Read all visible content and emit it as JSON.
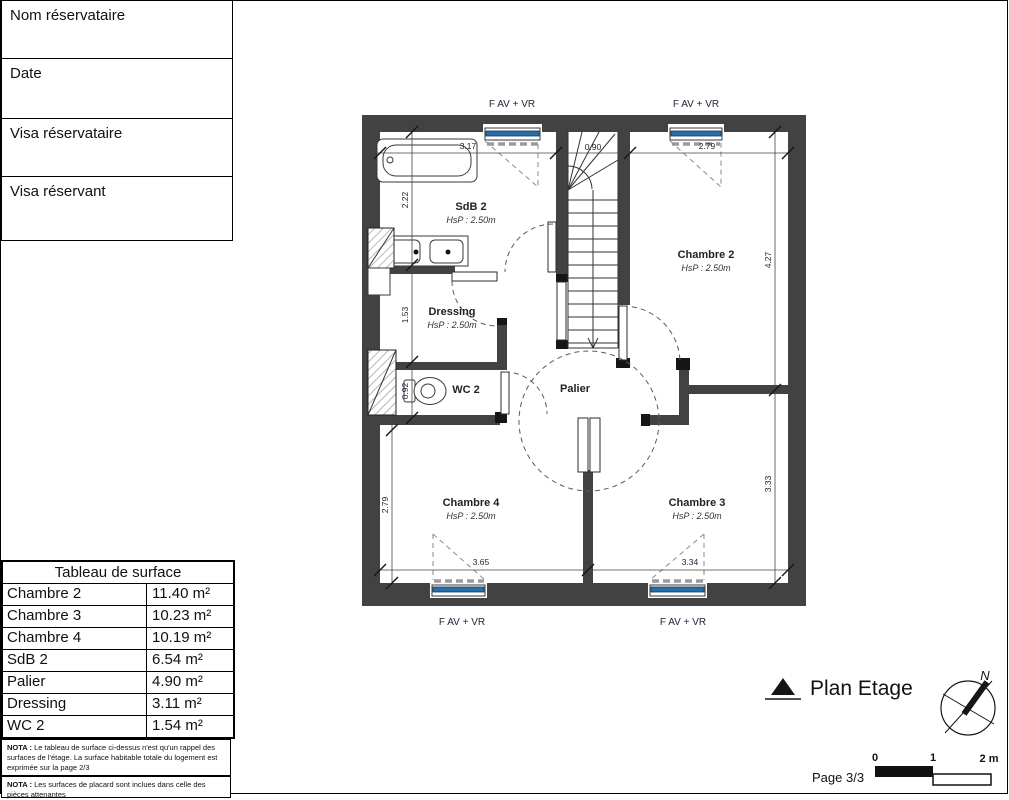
{
  "form": {
    "rows": [
      {
        "label": "Nom réservataire"
      },
      {
        "label": "Date"
      },
      {
        "label": "Visa réservataire"
      },
      {
        "label": "Visa réservant"
      }
    ]
  },
  "surface_table": {
    "title": "Tableau de surface",
    "rows": [
      {
        "name": "Chambre 2",
        "area": "11.40 m²"
      },
      {
        "name": "Chambre 3",
        "area": "10.23 m²"
      },
      {
        "name": "Chambre 4",
        "area": "10.19 m²"
      },
      {
        "name": "SdB 2",
        "area": "6.54 m²"
      },
      {
        "name": "Palier",
        "area": "4.90 m²"
      },
      {
        "name": "Dressing",
        "area": "3.11 m²"
      },
      {
        "name": "WC 2",
        "area": "1.54 m²"
      }
    ],
    "notes": [
      {
        "prefix": "NOTA :",
        "text": "Le tableau de surface ci-dessus n'est qu'un rappel des surfaces de l'étage. La surface habitable totale du logement est exprimée sur la page 2/3"
      },
      {
        "prefix": "NOTA :",
        "text": "Les surfaces de placard sont inclues dans celle des pièces attenantes"
      }
    ]
  },
  "plan": {
    "window_label": "F AV + VR",
    "rooms": [
      {
        "name": "SdB 2",
        "hsp": "HsP : 2.50m"
      },
      {
        "name": "Dressing",
        "hsp": "HsP : 2.50m"
      },
      {
        "name": "WC 2",
        "hsp": ""
      },
      {
        "name": "Palier",
        "hsp": ""
      },
      {
        "name": "Chambre 2",
        "hsp": "HsP : 2.50m"
      },
      {
        "name": "Chambre 3",
        "hsp": "HsP : 2.50m"
      },
      {
        "name": "Chambre 4",
        "hsp": "HsP : 2.50m"
      }
    ],
    "dims": {
      "top": [
        "3.17",
        "0.90",
        "2.79"
      ],
      "left": [
        "2.22",
        "1.53",
        "0.92",
        "2.79"
      ],
      "right": [
        "4.27",
        "3.33"
      ],
      "bottom": [
        "3.65",
        "3.34"
      ]
    }
  },
  "footer": {
    "title": "Plan Etage",
    "page": "Page 3/3",
    "north": "N",
    "scale": [
      "0",
      "1",
      "2 m"
    ]
  },
  "colors": {
    "wall": "#424242",
    "glass": "#2a6ca8"
  }
}
